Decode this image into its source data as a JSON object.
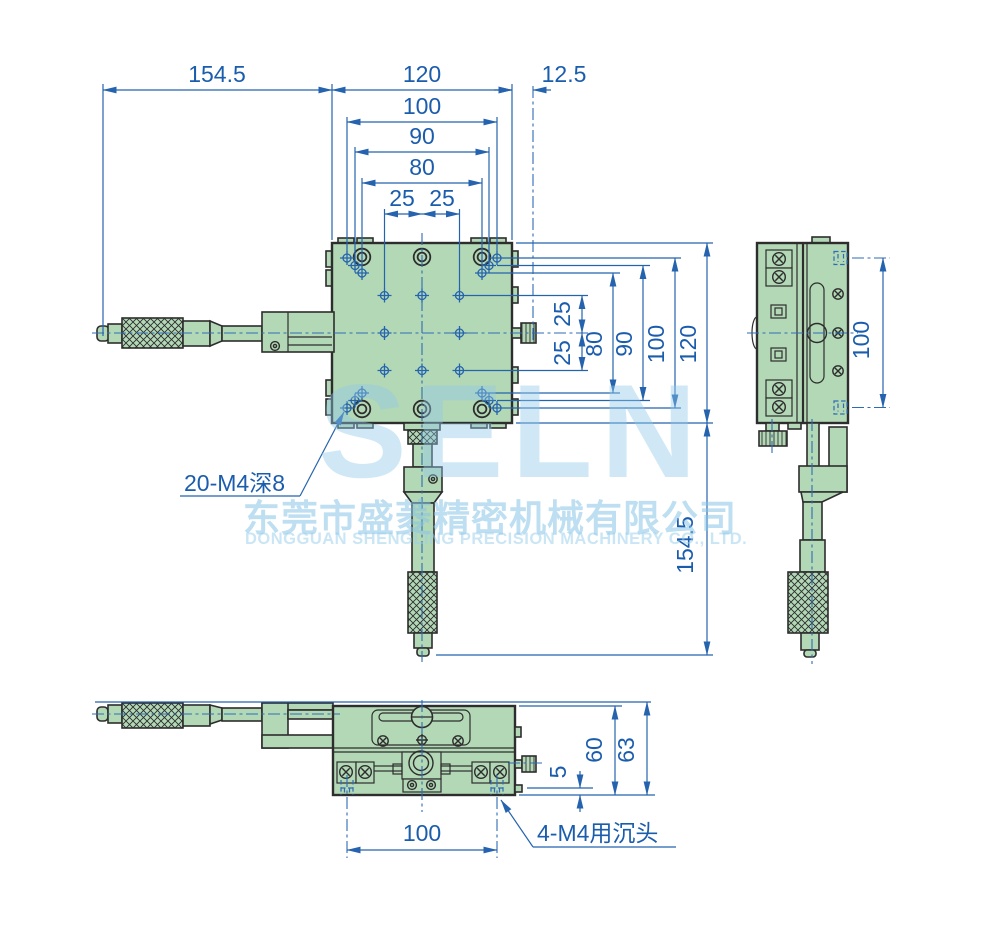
{
  "watermark": {
    "brand": "SELN",
    "company_cn": "东莞市盛菱精密机械有限公司",
    "company_en": "DONGGUAN SHENGLING PRECISION MACHINERY CO., LTD."
  },
  "callouts": {
    "top_plate_holes": "20-M4深8",
    "base_mount_holes": "4-M4用沉头"
  },
  "colors": {
    "body_green": "#b3d8b6",
    "outline_dark": "#2d2d2d",
    "dim_blue": "#2563ae",
    "watermark_blue": "#cfe8f6"
  },
  "dims": {
    "top": {
      "d154_5": "154.5",
      "d120": "120",
      "d12_5": "12.5",
      "d100": "100",
      "d90": "90",
      "d80": "80",
      "d25a": "25",
      "d25b": "25"
    },
    "right": {
      "d25t": "25",
      "d25b": "25",
      "d80": "80",
      "d90": "90",
      "d100": "100",
      "d120": "120",
      "d154_5": "154.5"
    },
    "side": {
      "d100": "100"
    },
    "bottom": {
      "d100": "100",
      "d5": "5",
      "d60": "60",
      "d63": "63"
    }
  }
}
